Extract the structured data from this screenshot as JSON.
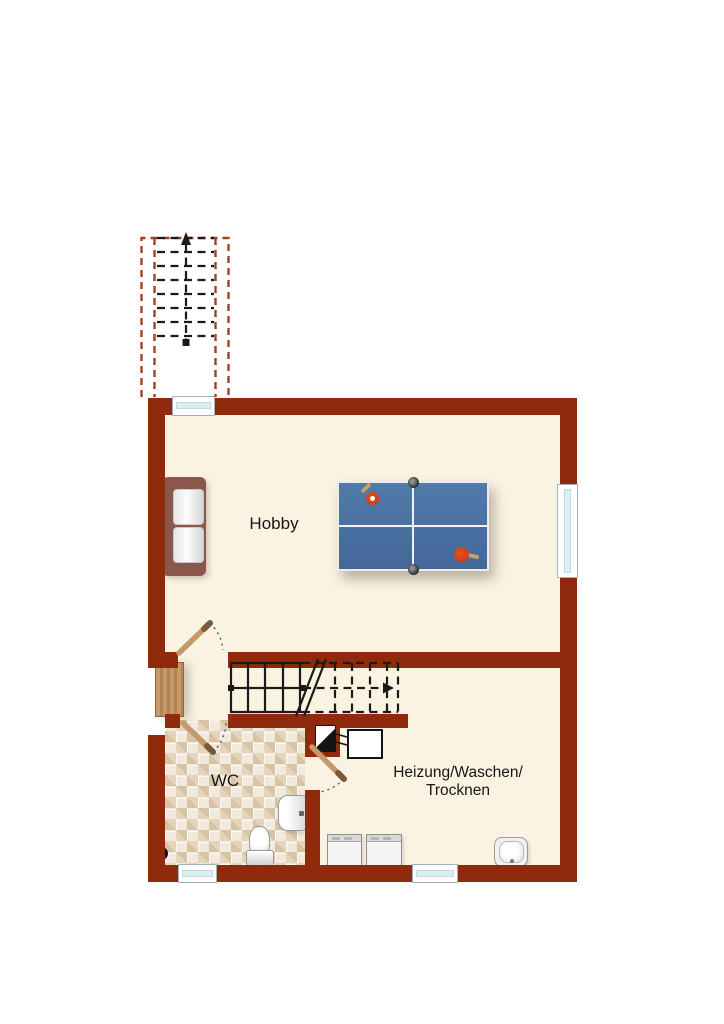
{
  "title": "Basement floor plan",
  "rooms": {
    "hobby": {
      "label": "Hobby"
    },
    "wc": {
      "label": "WC"
    },
    "utility": {
      "label_line1": "Heizung/Waschen/",
      "label_line2": "Trocknen"
    }
  },
  "icons": {
    "chimney": "chimney-flue-symbol",
    "floor_drain": "floor-drain-symbol",
    "stair_up_arrow": "arrow-up",
    "stair_run_arrow": "arrow-right"
  },
  "colors": {
    "page_background": "#FFFFFF",
    "wall": "#8F2A0D",
    "floor": "#FBF3E2",
    "stair_outline_red": "#A04226",
    "line_black": "#1A1A1A",
    "tile_base": "#F0E9DC",
    "tile_dark": "#D8C3A4",
    "tile_mid": "#E4D4BC",
    "wood": "#C49A6C",
    "window_glass": "#D9EFF3",
    "table_blue": "#44679A",
    "paddle_red": "#C8380D",
    "sofa_frame": "#8A574A"
  }
}
